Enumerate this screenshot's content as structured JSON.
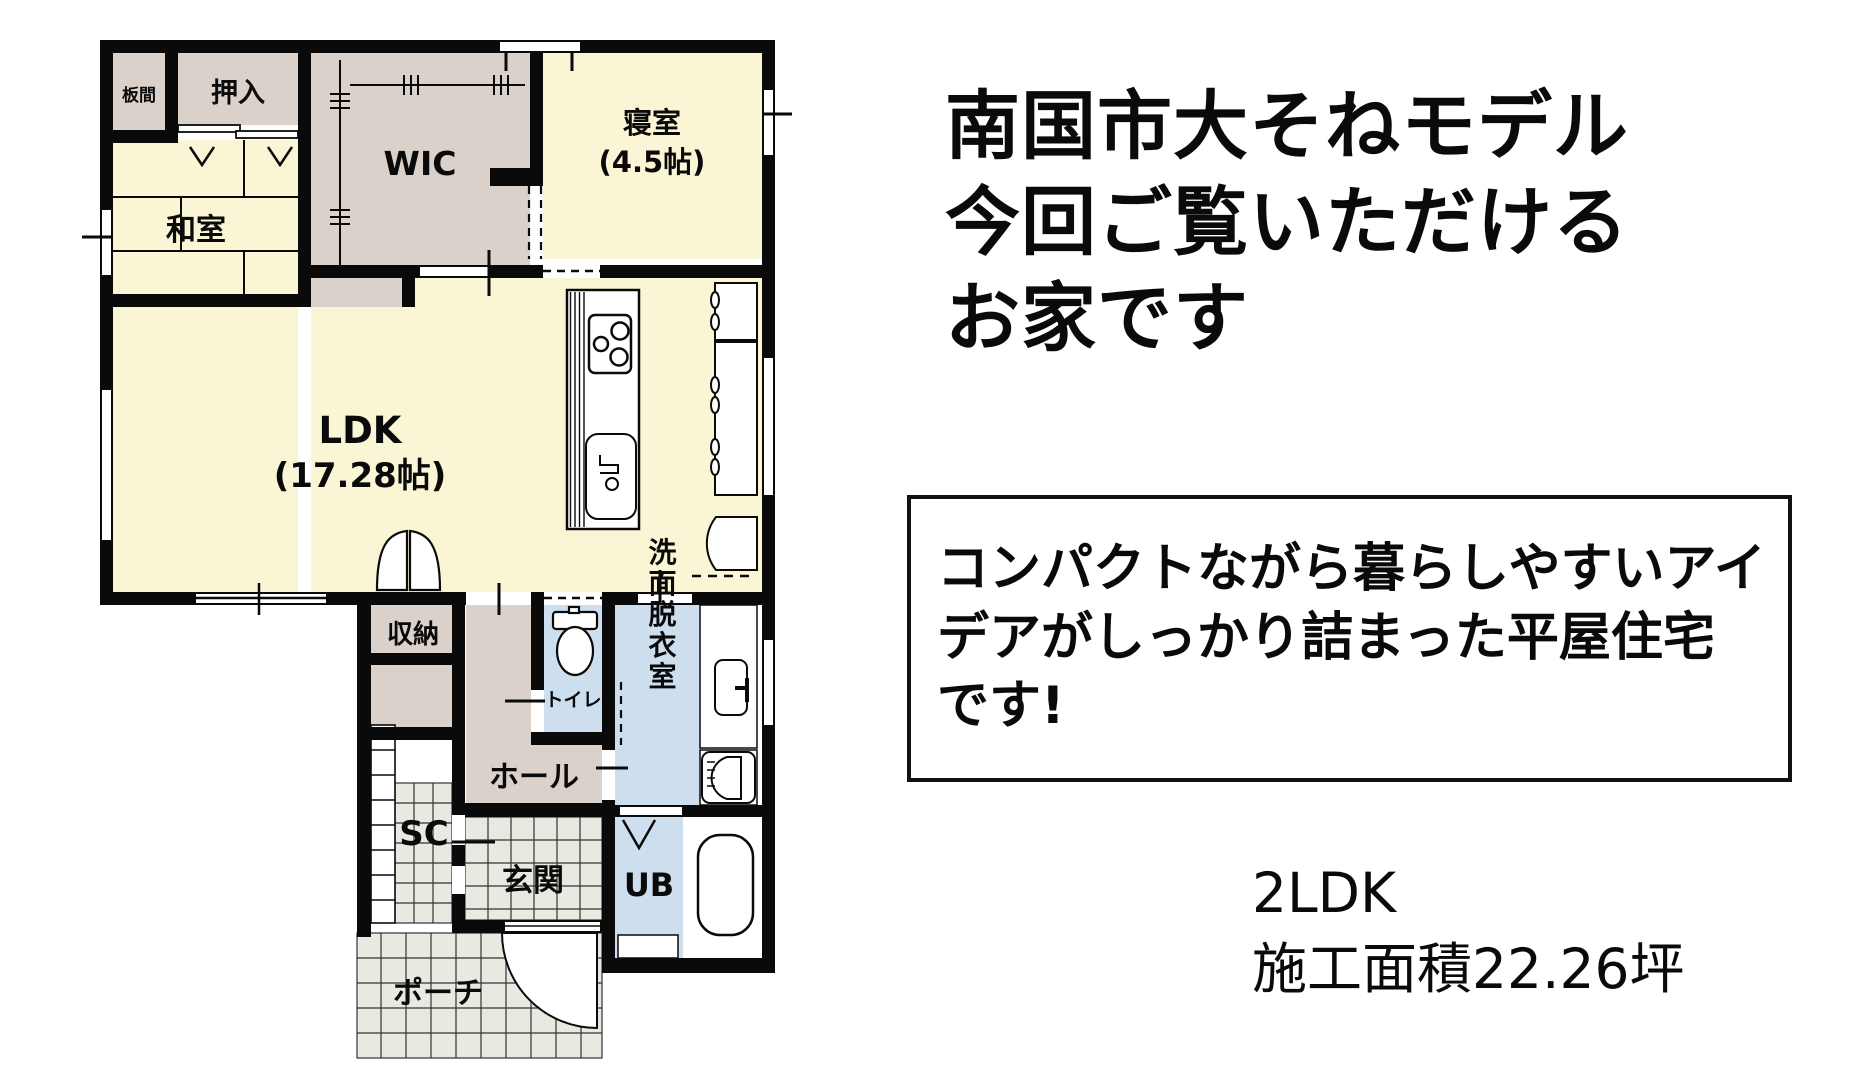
{
  "floor_plan": {
    "rooms": {
      "itanoma": {
        "label": "板間"
      },
      "oshiire": {
        "label": "押入"
      },
      "washitsu": {
        "label": "和室"
      },
      "wic": {
        "label": "WIC"
      },
      "bedroom": {
        "label": "寝室",
        "size": "(4.5帖)"
      },
      "ldk": {
        "label": "LDK",
        "size": "(17.28帖)"
      },
      "storage": {
        "label": "収納"
      },
      "toilet": {
        "label": "トイレ"
      },
      "washroom": {
        "label": "洗面脱衣室"
      },
      "hall": {
        "label": "ホール"
      },
      "shoe_closet": {
        "label": "SC"
      },
      "entrance": {
        "label": "玄関"
      },
      "unit_bath": {
        "label": "UB"
      },
      "porch": {
        "label": "ポーチ"
      }
    },
    "colors": {
      "room_yellow": "#FAF6D5",
      "room_gray": "#D9D1CA",
      "room_blue": "#CDDEEF",
      "tile_gray": "#E7EAE1",
      "wall_black": "#0A0A0A"
    }
  },
  "headline": {
    "lines": [
      "南国市大そねモデル",
      "今回ご覧いただける",
      "お家です"
    ]
  },
  "description_box": {
    "lines": [
      "コンパクトながら暮らしやすいアイ",
      "デアがしっかり詰まった平屋住宅",
      "です!"
    ]
  },
  "specs": {
    "layout_type": "2LDK",
    "area": "施工面積22.26坪"
  }
}
